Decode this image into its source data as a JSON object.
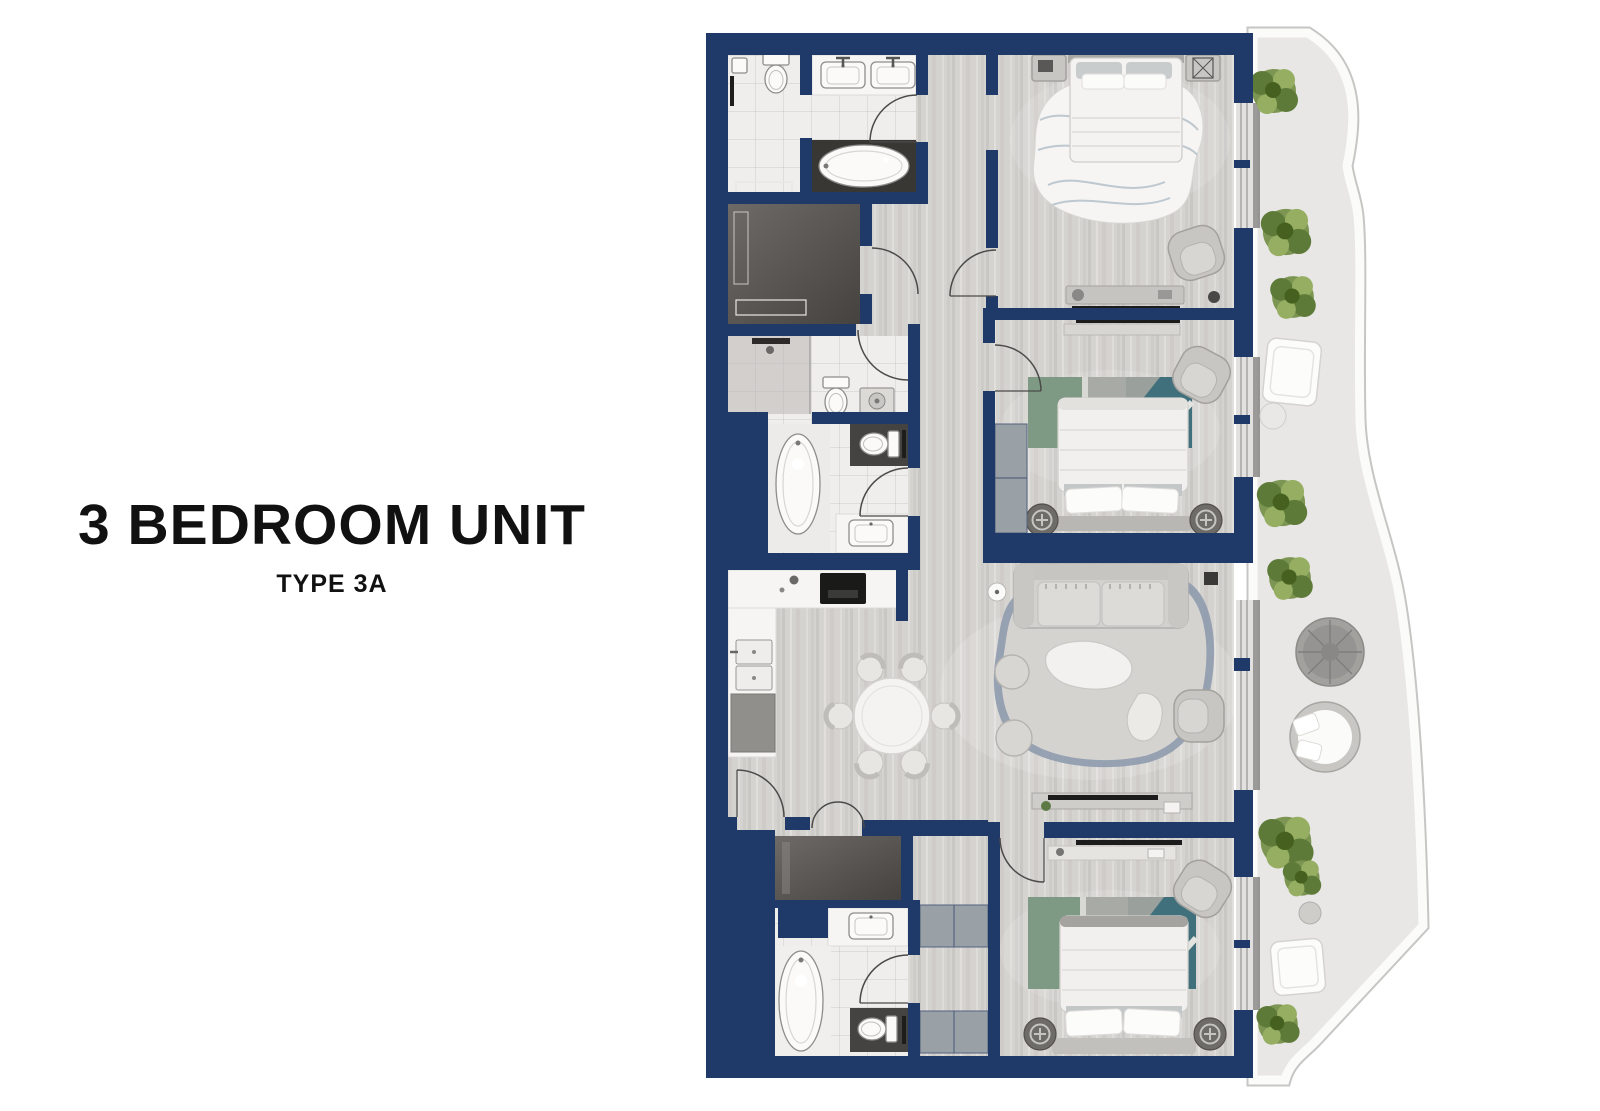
{
  "title": {
    "heading": "3 BEDROOM UNIT",
    "subheading": "TYPE 3A"
  },
  "plan": {
    "rooms": [
      "master-bathroom",
      "walk-in-closet",
      "master-bedroom",
      "bathroom-2",
      "bedroom-2",
      "kitchen",
      "dining-area",
      "living-room",
      "foyer",
      "bathroom-3",
      "dressing-area",
      "bedroom-3",
      "balcony"
    ],
    "furniture": [
      "double-bed-master",
      "double-bed-2",
      "double-bed-3",
      "sofa",
      "armchairs",
      "round-dining-table-6-chairs",
      "freestanding-bathtubs",
      "toilets",
      "sinks",
      "washer",
      "kitchen-counter-cooktop",
      "wardrobes",
      "rugs",
      "balcony-plants",
      "balcony-lounge-chairs",
      "rattan-table"
    ],
    "colors": {
      "wall": "#1f3a68",
      "wood_floor": "#d5d3d0",
      "tile_floor": "#efeeec",
      "dark_floor": "#5a5755",
      "balcony_floor": "#e8e7e5",
      "balcony_rim": "#fbfbfa",
      "wardrobe_gray": "#9aa1a6",
      "furniture_gray": "#c8c6c3",
      "furniture_light": "#f4f3f1",
      "fixture_white": "#fbfaf9",
      "rug_blue": "#8e9aad",
      "rug_green": "#7e9a84",
      "rug_teal": "#40707b",
      "plant_green": "#7c9552",
      "tv_black": "#1c1c1c"
    }
  }
}
